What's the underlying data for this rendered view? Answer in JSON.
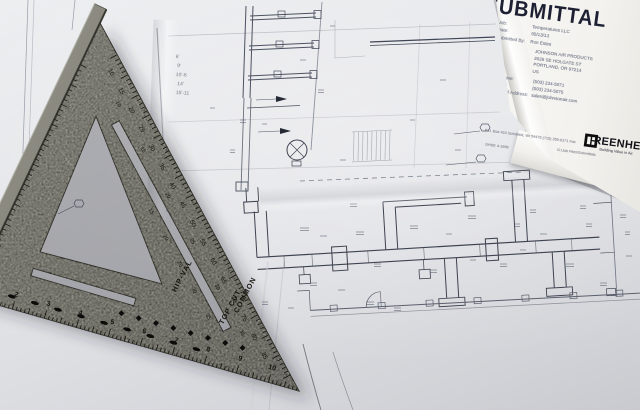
{
  "transmittal": {
    "title": "SUBMITTAL",
    "fields": [
      {
        "label": "Job:",
        "value": "Temperatures LLC"
      },
      {
        "label": "Date:",
        "value": "05/13/13"
      },
      {
        "label": "Submitted By:",
        "value": "Ron Estes"
      }
    ],
    "recipient": [
      "JOHNSON AIR PRODUCTS",
      "2626 SE HOLGATE ST",
      "PORTLAND, OR  97214",
      "US"
    ],
    "contact": [
      {
        "label": "Phone:",
        "value": "(503) 234-5071"
      },
      {
        "label": "Fax:",
        "value": "(503) 234-5075"
      },
      {
        "label": "Email Address:",
        "value": "sales@johnsonair.com"
      }
    ],
    "logo_text": "GREENHECK",
    "logo_tagline": "Building Value in Air.",
    "footer_address": "P.O. Box 410    Schofield, WI 54476    (715) 359-6171    Fax",
    "footer_note": "GHSE 4-1998",
    "footer_path": "G:\\Job Files\\Submittals"
  },
  "pencil_notes": [
    "6'",
    "9'",
    "10'-6",
    "14'",
    "15'-11"
  ],
  "speed_square": {
    "label_hipval": "HIP-VAL",
    "label_topcut": "TOP CUT",
    "label_common": "COMMON",
    "degree_numbers": [
      10,
      15,
      20,
      25,
      30,
      35,
      40,
      45,
      50,
      55,
      60,
      65,
      70,
      75,
      80,
      85
    ],
    "inch_numbers": [
      1,
      2,
      3,
      4,
      5,
      6,
      7,
      8,
      9,
      10
    ],
    "common_numbers": [
      10,
      15,
      20,
      25,
      30,
      35
    ],
    "hipval_numbers": [
      15,
      20,
      25,
      30,
      35
    ]
  }
}
